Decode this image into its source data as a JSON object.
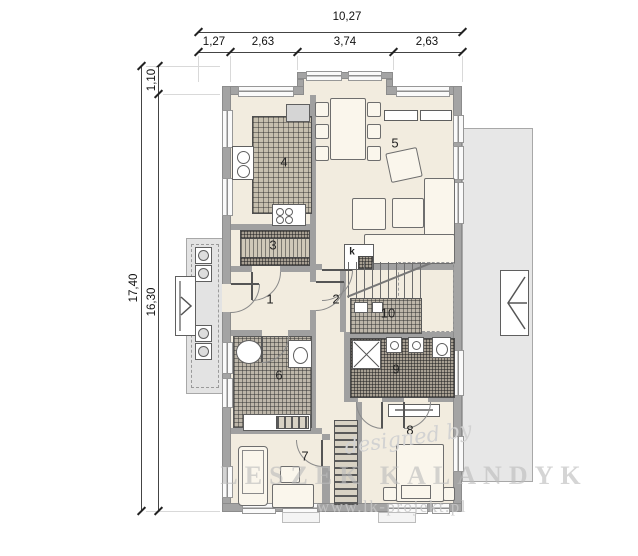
{
  "dimensions": {
    "top_total": "10,27",
    "top_segments": [
      "1,27",
      "2,63",
      "3,74",
      "2,63"
    ],
    "left_total": "17,40",
    "left_inner": "16,30",
    "left_offset": "1,10"
  },
  "rooms": {
    "r1": "1",
    "r2": "2",
    "r3": "3",
    "r4": "4",
    "r5": "5",
    "r6": "6",
    "r7": "7",
    "r8": "8",
    "r9": "9",
    "r10": "10"
  },
  "fireplace_label": "k",
  "watermark": {
    "designed_by": "designed by",
    "author": "LESZEK KALANDYK",
    "website": "www.lk-projekt.pl"
  },
  "colors": {
    "wall": "#a4a4a4",
    "floor": "#f2ecdf",
    "terrace": "#e7e7e7",
    "porch": "#e3e3e3",
    "dim_text": "#111111",
    "watermark": "#cccccc"
  }
}
